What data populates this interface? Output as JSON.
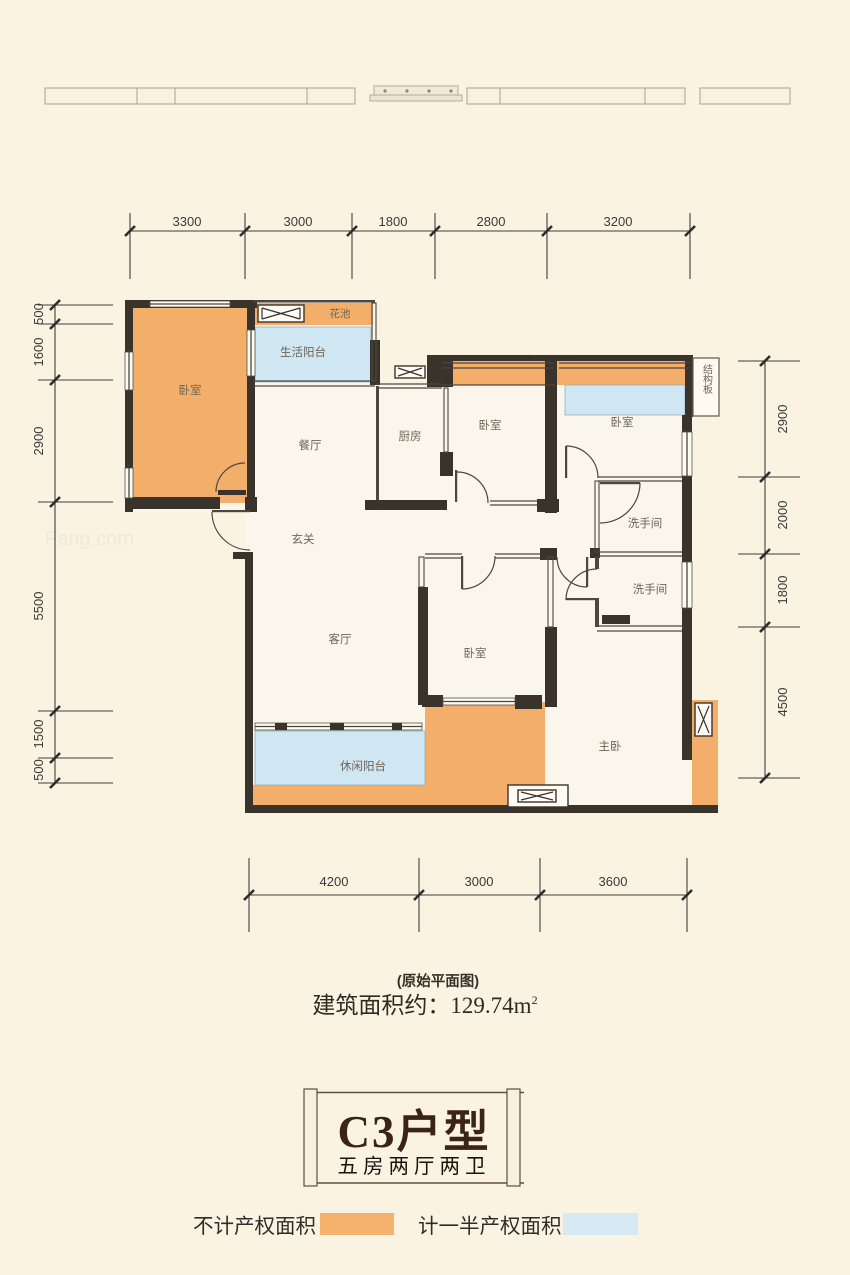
{
  "page": {
    "bg": "#faf3e1"
  },
  "colors": {
    "wall": "#3a332b",
    "no_property_orange": "#f3ae6a",
    "half_property_blue": "#cfe6f3",
    "legend_orange": "#f5b26d",
    "legend_blue": "#d7e9f5"
  },
  "dims": {
    "top": [
      "3300",
      "3000",
      "1800",
      "2800",
      "3200"
    ],
    "left": [
      "500",
      "1600",
      "2900",
      "5500",
      "1500",
      "500"
    ],
    "right": [
      "2900",
      "2000",
      "1800",
      "4500"
    ],
    "bottom": [
      "4200",
      "3000",
      "3600"
    ]
  },
  "rooms": {
    "bedroom_top_left": "卧室",
    "flower_bed": "花池",
    "service_balcony": "生活阳台",
    "dining_room": "餐厅",
    "kitchen": "厨房",
    "bedroom_top_mid": "卧室",
    "bedroom_top_right": "卧室",
    "structure_board": "结构板",
    "foyer": "玄关",
    "bathroom_upper": "洗手间",
    "bathroom_lower": "洗手间",
    "living_room": "客厅",
    "bedroom_mid": "卧室",
    "master_bedroom": "主卧",
    "leisure_balcony": "休闲阳台"
  },
  "area_note": {
    "caption": "(原始平面图)",
    "label": "建筑面积约：",
    "value": "129.74",
    "unit": "m",
    "unit_sup": "2"
  },
  "title": {
    "name": "C3户型",
    "subtitle": "五房两厅两卫"
  },
  "legend": {
    "item1": "不计产权面积",
    "item2": "计一半产权面积"
  },
  "watermark": {
    "t1": "房天下fang.com",
    "t2": "Fang.com"
  }
}
